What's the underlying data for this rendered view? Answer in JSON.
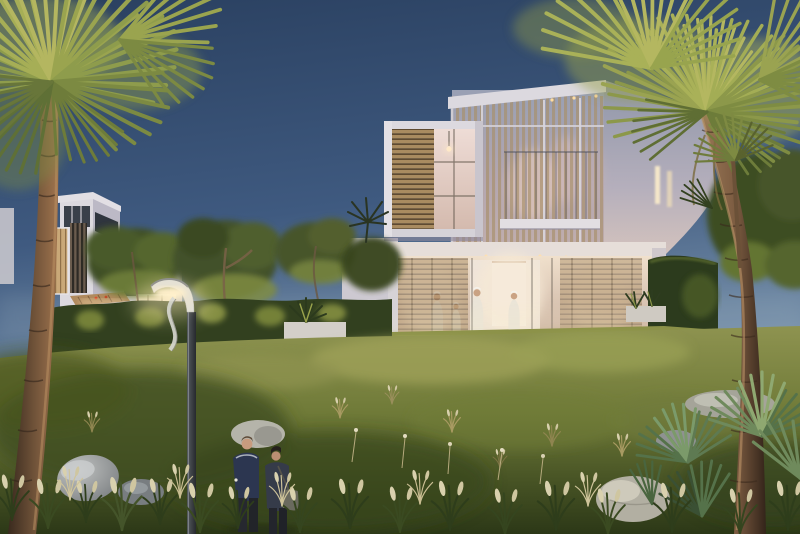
{
  "scene": {
    "people": {
      "walking_in_foreground": 2,
      "inside_villa_ground_floor": 4
    },
    "buildings": {
      "main_villa_floors": 2,
      "secondary_villas": 1
    },
    "lighting": "dusk"
  },
  "palette": {
    "sky_top": "#2a4060",
    "sky_mid": "#3f5a80",
    "sky_horizon": "#7e97af",
    "villa_white": "#dcd9df",
    "villa_side_wall": "#8f96a9",
    "warm_interior": "#f0e0cc",
    "louver_wood": "#a98b60",
    "hedge_dark": "#32401f",
    "hedge_lit": "#86913f",
    "grass_lit": "#8e9350",
    "grass_shadow": "#4a5626",
    "grass_foreground": "#2c3817",
    "palm_frond_lit": "#b4b760",
    "palm_frond": "#8c984a",
    "palm_trunk": "#7c5c41",
    "rock_light": "#c0c2c1",
    "lamp_glow": "#fff3d4",
    "man_outfit": "#2c3650",
    "woman_outfit": "#353b49"
  }
}
